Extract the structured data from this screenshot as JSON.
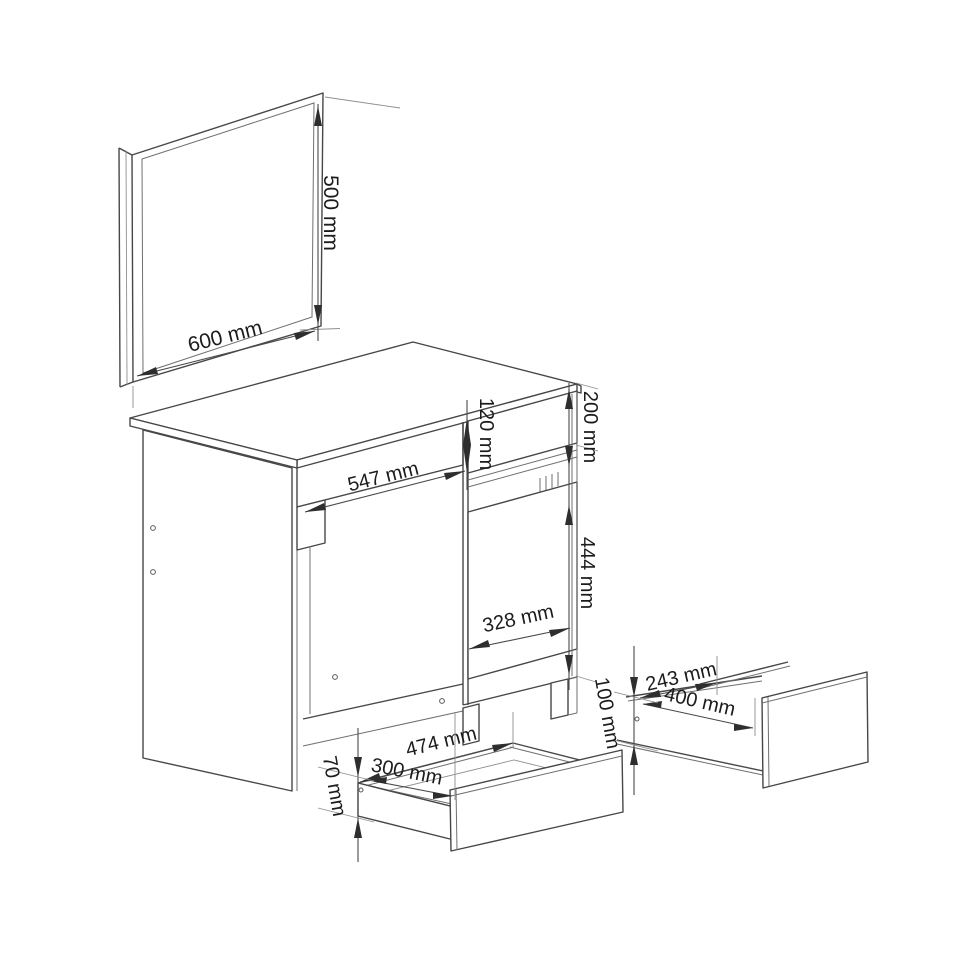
{
  "unit": "mm",
  "mirror": {
    "width_label": "600 mm",
    "height_label": "500 mm"
  },
  "desk": {
    "knee_opening_width_label": "547 mm",
    "top_drawer_front_height_label": "120 mm",
    "top_section_height_label": "200 mm",
    "door_width_label": "328 mm",
    "door_height_label": "444 mm"
  },
  "center_drawer": {
    "width_label": "474 mm",
    "depth_label": "300 mm",
    "height_label": "70 mm"
  },
  "side_drawer": {
    "depth_label": "243 mm",
    "width_label": "400 mm",
    "height_label": "100 mm"
  }
}
